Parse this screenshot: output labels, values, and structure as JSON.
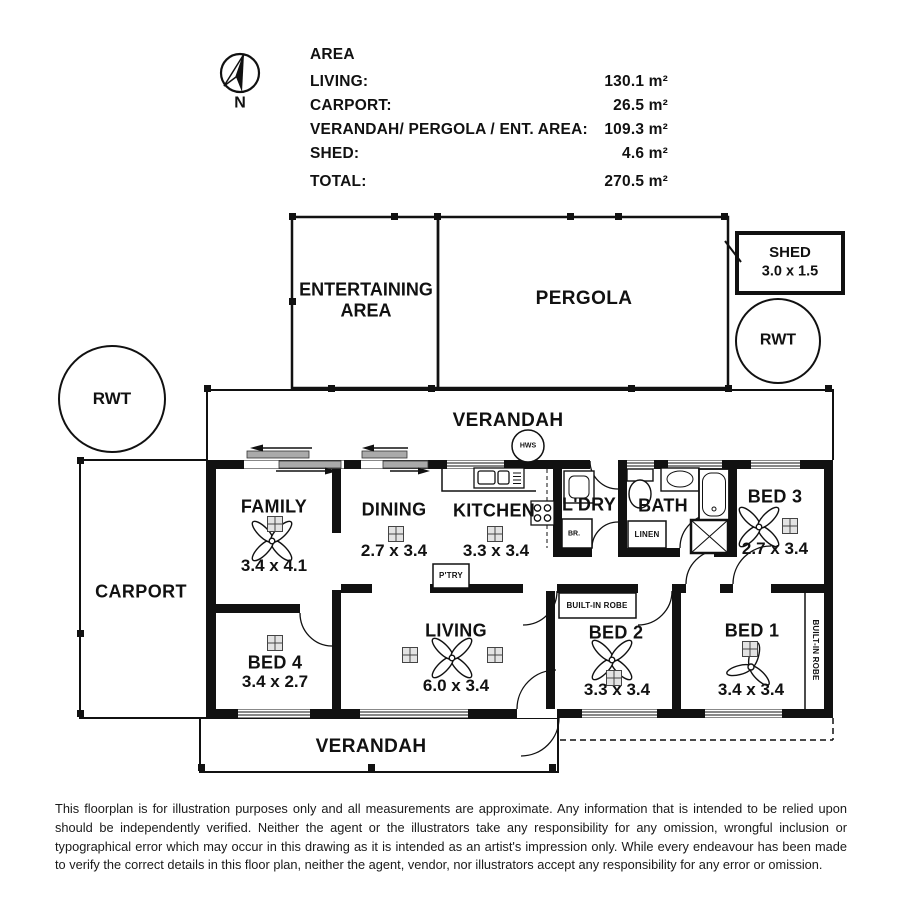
{
  "compass": {
    "label": "N"
  },
  "area": {
    "title": "AREA",
    "rows": [
      {
        "label": "LIVING:",
        "value": "130.1 m²"
      },
      {
        "label": "CARPORT:",
        "value": "26.5 m²"
      },
      {
        "label": "VERANDAH/ PERGOLA / ENT. AREA:",
        "value": "109.3 m²"
      },
      {
        "label": "SHED:",
        "value": "4.6 m²"
      }
    ],
    "total": {
      "label": "TOTAL:",
      "value": "270.5 m²"
    }
  },
  "outdoor": {
    "entertaining_line1": "ENTERTAINING",
    "entertaining_line2": "AREA",
    "pergola": "PERGOLA",
    "shed_name": "SHED",
    "shed_dims": "3.0 x 1.5",
    "rwt_left": "RWT",
    "rwt_right": "RWT",
    "verandah_top": "VERANDAH",
    "verandah_bottom": "VERANDAH",
    "carport": "CARPORT",
    "hws": "HWS"
  },
  "rooms": {
    "family": {
      "name": "FAMILY",
      "dims": "3.4 x 4.1"
    },
    "dining": {
      "name": "DINING",
      "dims": "2.7 x 3.4"
    },
    "kitchen": {
      "name": "KITCHEN",
      "dims": "3.3 x 3.4"
    },
    "laundry": {
      "name": "L'DRY"
    },
    "bath": {
      "name": "BATH"
    },
    "bed3": {
      "name": "BED 3",
      "dims": "2.7 x 3.4"
    },
    "living": {
      "name": "LIVING",
      "dims": "6.0 x 3.4"
    },
    "bed4": {
      "name": "BED 4",
      "dims": "3.4 x 2.7"
    },
    "bed2": {
      "name": "BED 2",
      "dims": "3.3 x 3.4"
    },
    "bed1": {
      "name": "BED 1",
      "dims": "3.4 x 3.4"
    }
  },
  "closets": {
    "pantry": "P'TRY",
    "broom": "BR.",
    "linen": "LINEN",
    "robe_bed2": "BUILT-IN ROBE",
    "robe_bed1": "BUILT-IN ROBE"
  },
  "disclaimer": "This floorplan is for illustration purposes only and all measurements are approximate. Any information that is intended to be relied upon should be independently verified. Neither the agent or the illustrators take any responsibility for any omission, wrongful inclusion or typographical error which may occur in this drawing as it is intended as an artist's impression only. While every endeavour has been made to verify the correct details in this floor plan, neither the agent, vendor, nor illustrators accept any responsibility for any error or omission."
}
